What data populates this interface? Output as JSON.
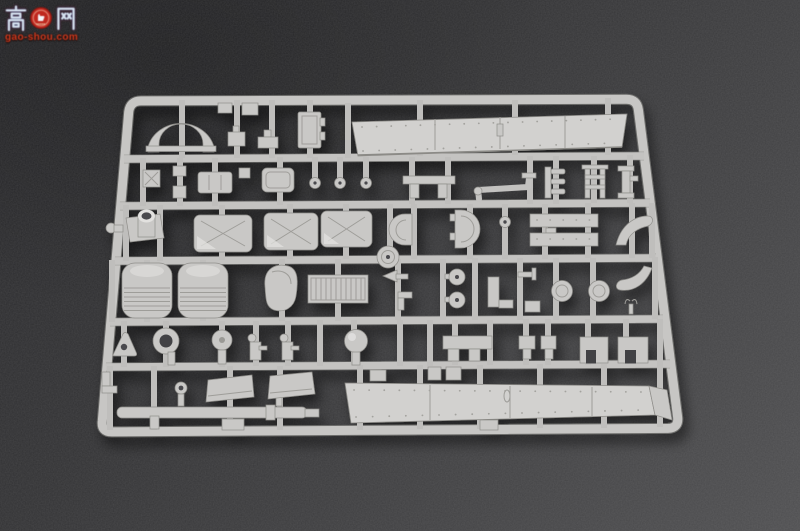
{
  "watermark": {
    "char_left": "高",
    "char_right": "网",
    "badge": "red thumbs-up seal logo",
    "domain": "gao-shou.com"
  },
  "scene": {
    "subject": "light grey injection-moulded model kit sprue with many small armour-vehicle parts",
    "surface": "dark grey textured backdrop"
  },
  "colors": {
    "background_top_left": "#28282a",
    "background_bottom_right": "#4f4f51",
    "sprue_plastic": "#c8c7c5",
    "sprue_plate": "#d2d1cf",
    "sprue_highlight": "#e2e1df",
    "sprue_shadow_line": "#8f8e8a",
    "watermark_red": "#d03a1d",
    "watermark_glyph_blue": "#d5e1ef"
  }
}
